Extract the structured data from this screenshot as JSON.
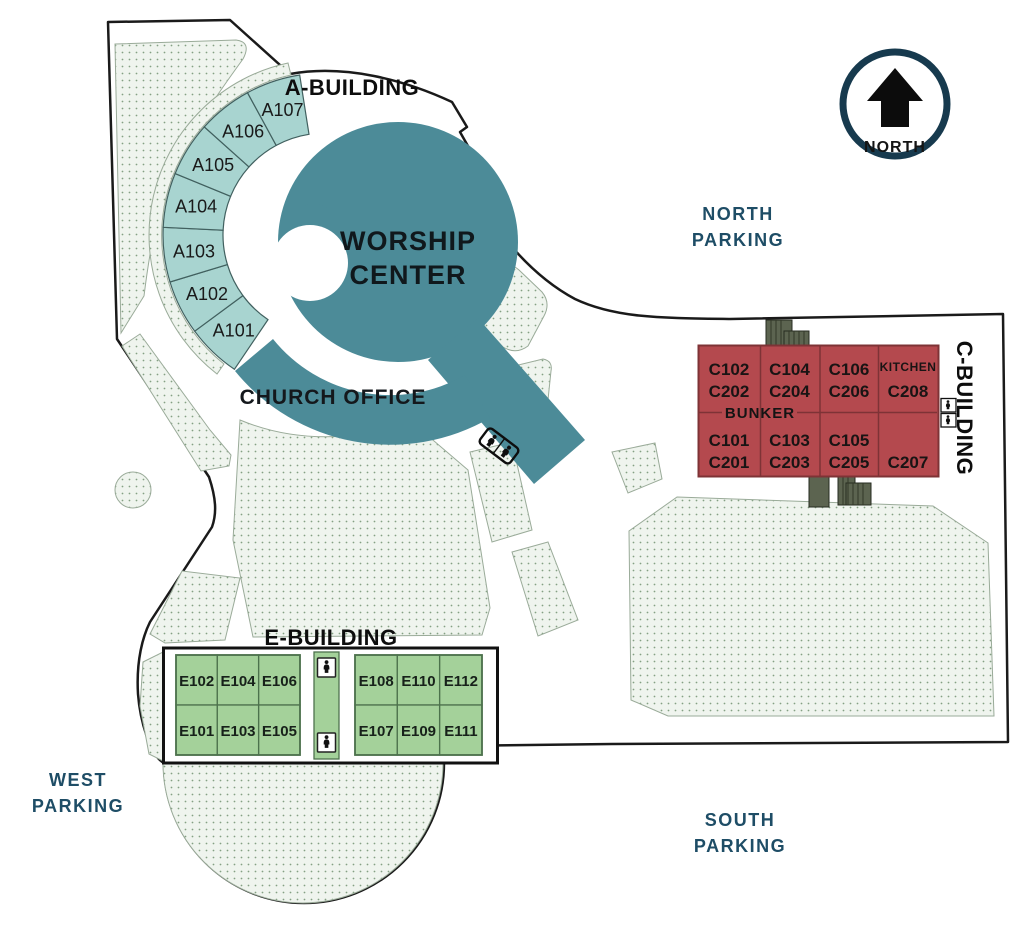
{
  "map": {
    "compass": {
      "label": "NORTH"
    },
    "parking": {
      "north": {
        "line1": "NORTH",
        "line2": "PARKING"
      },
      "west": {
        "line1": "WEST",
        "line2": "PARKING"
      },
      "south": {
        "line1": "SOUTH",
        "line2": "PARKING"
      }
    },
    "buildings": {
      "a": {
        "label": "A-BUILDING",
        "rooms": [
          "A101",
          "A102",
          "A103",
          "A104",
          "A105",
          "A106",
          "A107"
        ]
      },
      "worship": {
        "line1": "WORSHIP",
        "line2": "CENTER"
      },
      "office": {
        "label": "CHURCH OFFICE"
      },
      "c": {
        "label": "C-BUILDING",
        "bunker": "BUNKER",
        "top_cells": [
          [
            "C102",
            "C202"
          ],
          [
            "C104",
            "C204"
          ],
          [
            "C106",
            "C206"
          ],
          [
            "KITCHEN",
            "C208"
          ]
        ],
        "bottom_cells": [
          [
            "C101",
            "C201"
          ],
          [
            "C103",
            "C203"
          ],
          [
            "C105",
            "C205"
          ],
          [
            "",
            "C207"
          ]
        ]
      },
      "e": {
        "label": "E-BUILDING",
        "left_top": [
          "E102",
          "E104",
          "E106"
        ],
        "left_bottom": [
          "E101",
          "E103",
          "E105"
        ],
        "right_top": [
          "E108",
          "E110",
          "E112"
        ],
        "right_bottom": [
          "E107",
          "E109",
          "E111"
        ]
      }
    },
    "icons": {
      "compass_arrow": "north-arrow-icon",
      "restroom": "restroom-icon",
      "stairs": "stairs-icon"
    },
    "colors": {
      "worship_teal": "#4C8B98",
      "a_room_teal": "#A8D4D0",
      "c_red": "#B4494E",
      "c_line": "#7E3336",
      "e_green": "#A4D19A",
      "e_line": "#4D724D",
      "lawn": "#EFF4EE",
      "lawn_dot": "#84A084",
      "lawn_edge": "#9AAB99",
      "parking_text": "#1E4D66",
      "compass_ring": "#173A4E",
      "stairs_olive": "#5C6450",
      "outline": "#1A1A1A"
    }
  }
}
